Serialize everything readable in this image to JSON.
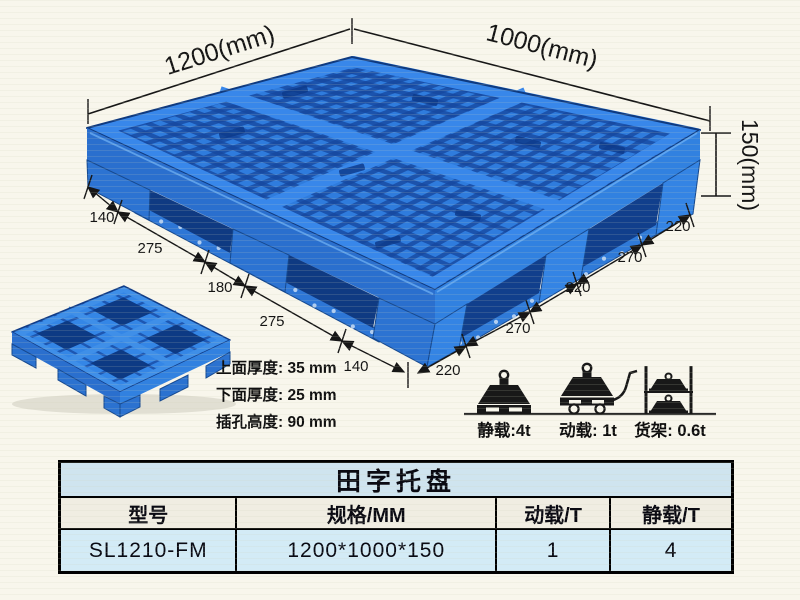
{
  "diagram": {
    "dimensions": {
      "top_left_edge": "1200(mm)",
      "top_right_edge": "1000(mm)",
      "height": "150(mm)",
      "left_edge_segments": [
        "140",
        "275",
        "180",
        "275",
        "140"
      ],
      "right_edge_segments": [
        "220",
        "270",
        "220",
        "270",
        "220"
      ]
    },
    "thickness_notes": [
      "上面厚度: 35 mm",
      "下面厚度: 25 mm",
      "插孔高度: 90 mm"
    ],
    "load_ratings": [
      {
        "icon": "static-load-icon",
        "label": "静载:4t"
      },
      {
        "icon": "dynamic-load-icon",
        "label": "动载: 1t"
      },
      {
        "icon": "rack-load-icon",
        "label": "货架: 0.6t"
      }
    ],
    "colors": {
      "pallet_blue": "#2f7cdd",
      "pallet_hole_blue": "#17489f",
      "pallet_recess_blue": "#0f3a82",
      "annotation_black": "#161616",
      "background": "#f8f6ec"
    }
  },
  "table": {
    "title": "田字托盘",
    "columns": [
      "型号",
      "规格/MM",
      "动载/T",
      "静载/T"
    ],
    "rows": [
      {
        "model": "SL1210-FM",
        "spec_mm": "1200*1000*150",
        "dynamic_load_t": "1",
        "static_load_t": "4"
      }
    ],
    "colors": {
      "title_bg": "#cfe4ef",
      "header_bg": "#f0ede2",
      "row_bg": "#d3ebf6",
      "border": "#000000"
    }
  }
}
